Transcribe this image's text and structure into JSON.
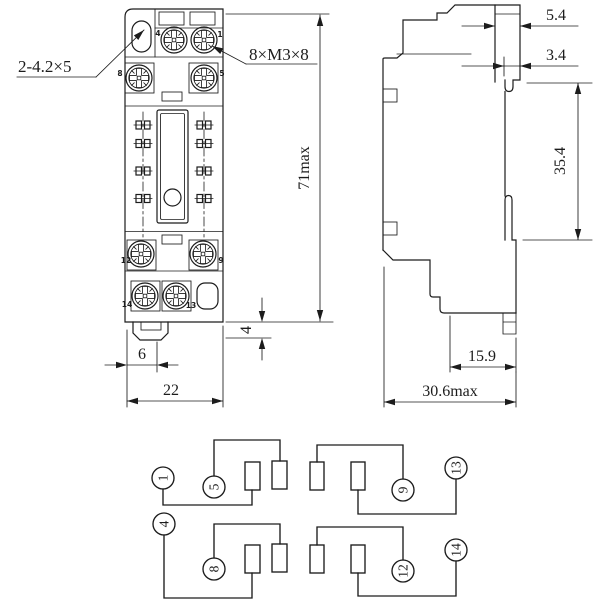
{
  "drawing": {
    "front_view": {
      "callouts": {
        "mounting_holes": "2-4.2×5",
        "terminal_screws": "8×M3×8"
      },
      "dimensions": {
        "overall_height": "71max",
        "latch_height": "4",
        "latch_offset": "6",
        "body_width": "22"
      },
      "terminal_numbers": {
        "r1_left": "4",
        "r1_right": "1",
        "r2_left": "8",
        "r2_right": "5",
        "r3_left": "12",
        "r3_right": "9",
        "r4_left": "14",
        "r4_right": "13"
      }
    },
    "side_view": {
      "dimensions": {
        "top_tab_width": "5.4",
        "rail_hook_width": "3.4",
        "rail_section_height": "35.4",
        "terminal_depth": "15.9",
        "overall_depth": "30.6max"
      }
    },
    "schematic": {
      "terminals": {
        "t1": "1",
        "t5": "5",
        "t9": "9",
        "t13": "13",
        "t4": "4",
        "t8": "8",
        "t12": "12",
        "t14": "14"
      }
    },
    "colors": {
      "line": "#1c1c1c",
      "background": "#ffffff"
    }
  }
}
